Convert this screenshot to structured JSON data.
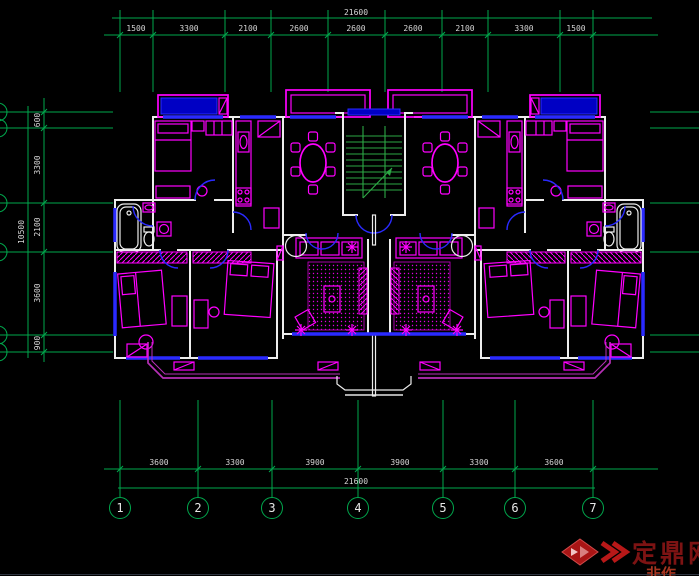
{
  "dimensions": {
    "top": {
      "overall": "21600",
      "segments": [
        "1500",
        "3300",
        "2100",
        "2600",
        "2600",
        "2600",
        "2100",
        "3300",
        "1500"
      ]
    },
    "bottom": {
      "overall": "21600",
      "segments": [
        "3600",
        "3300",
        "3900",
        "3900",
        "3300",
        "3600"
      ]
    },
    "left": {
      "overall": "10500",
      "segments": [
        "600",
        "3300",
        "2100",
        "3600",
        "900"
      ]
    }
  },
  "grid_bubbles": [
    "1",
    "2",
    "3",
    "4",
    "5",
    "6",
    "7"
  ],
  "watermark": {
    "site_name": "定鼎网",
    "partial_text": "非作"
  },
  "colors": {
    "background": "#000000",
    "grid_line": "#00a84d",
    "dimension_text": "#d6d6d6",
    "wall": "#ededed",
    "furniture": "#ff00ff",
    "window_door": "#2a2aff",
    "window_fill": "#0000c4",
    "balcony_rail": "#b62fb6",
    "stair": "#2da845",
    "watermark_red": "#7d1313"
  }
}
